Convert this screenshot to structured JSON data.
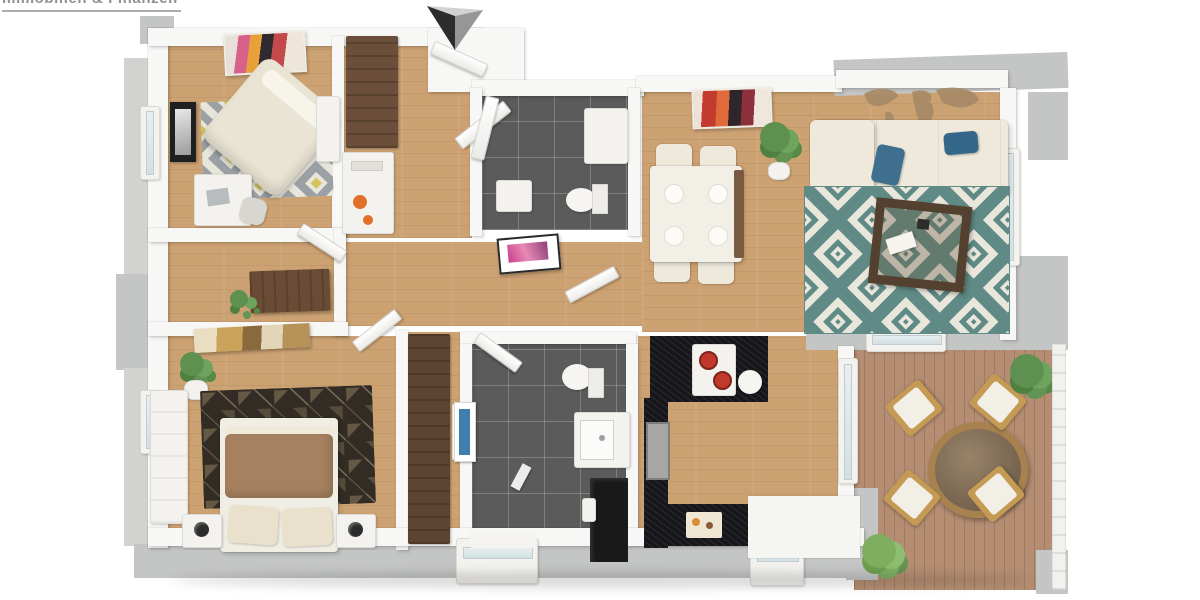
{
  "brand": {
    "logo_text": "Immobilien & Finanzen"
  },
  "compass": {
    "icon": "north-arrow",
    "dark_face": "#2c2c2c",
    "mid_face": "#969696",
    "light_face": "#d2d2d2"
  },
  "colors": {
    "bg": "#ffffff",
    "exterior_wall": "#c4c5c5",
    "wood_floor": "#cda273",
    "deck": "#b48d72",
    "tile_dark": "#5b5b5b",
    "counter_black": "#17171b",
    "furniture_brown": "#6b4f3a",
    "plant_green": "#5e9150",
    "rug_teal": "#5f8a85",
    "rug_cream": "#e9e6dc",
    "rug_gray": "#9aa0a4",
    "rug_yellow": "#d2c35a",
    "rug_dark_base": "#332c25",
    "sofa_cream": "#efe9db",
    "pillow_blue": "#3f6f8e",
    "duvet_brown": "#a5815f",
    "accent_orange": "#e2702a",
    "art_pink": "#c93f8c",
    "art_red": "#c23b2e",
    "map_tan": "#a78b66"
  },
  "floorplan": {
    "type": "3d-floor-plan-top-view",
    "rooms": [
      {
        "id": "bedroom-top-left",
        "furniture": [
          "double-bed",
          "diamond-rug",
          "desk",
          "desk-chair",
          "wardrobe",
          "shelf",
          "wall-art",
          "framed-photo"
        ]
      },
      {
        "id": "hall-closet",
        "furniture": [
          "wardrobe",
          "shelf",
          "open-doors",
          "orange-decor"
        ]
      },
      {
        "id": "bathroom-top",
        "furniture": [
          "shower",
          "toilet",
          "sink",
          "pink-wall-art"
        ]
      },
      {
        "id": "dining-living",
        "furniture": [
          "dining-table",
          "four-chairs",
          "plates",
          "potted-plant",
          "red-wall-art",
          "world-map-decal",
          "corner-sofa",
          "blue-pillows",
          "teal-diamond-rug",
          "coffee-table",
          "window-door"
        ]
      },
      {
        "id": "hallway",
        "furniture": [
          "console-table",
          "small-plant",
          "open-doors"
        ]
      },
      {
        "id": "bedroom-bottom-left",
        "furniture": [
          "double-bed",
          "brown-duvet",
          "dark-pattern-rug",
          "two-nightstands",
          "two-lamps",
          "wardrobe",
          "potted-plant",
          "gold-wall-art"
        ]
      },
      {
        "id": "bathroom-bottom",
        "furniture": [
          "toilet",
          "vanity-sink",
          "shower",
          "blue-towel",
          "bath-mat"
        ]
      },
      {
        "id": "kitchen",
        "furniture": [
          "black-island",
          "hob-with-pots",
          "black-counter",
          "sink",
          "cutting-board"
        ]
      },
      {
        "id": "terrace",
        "furniture": [
          "round-glass-table",
          "four-deck-chairs",
          "two-potted-plants",
          "railing"
        ]
      }
    ]
  }
}
